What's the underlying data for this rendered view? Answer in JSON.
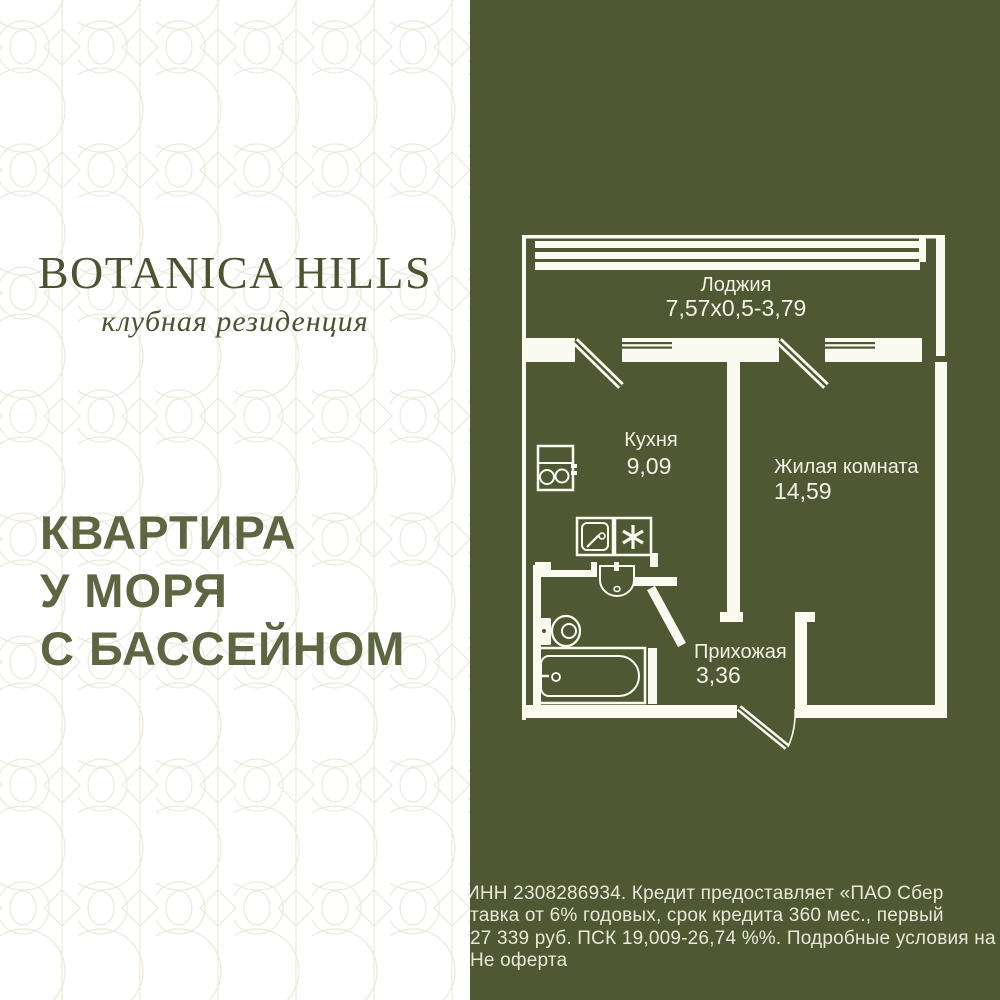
{
  "brand": {
    "name": "BOTANICA HILLS",
    "tagline": "клубная резиденция"
  },
  "headline": {
    "line1": "КВАРТИРА",
    "line2": "У МОРЯ",
    "line3": "С БАССЕЙНОМ"
  },
  "floor_plan": {
    "loggia_label": "Лоджия",
    "loggia_dims": "7,57x0,5-3,79",
    "kitchen_label": "Кухня",
    "kitchen_area": "9,09",
    "living_label": "Жилая комната",
    "living_area": "14,59",
    "hallway_label": "Прихожая",
    "hallway_area": "3,36"
  },
  "disclaimer": {
    "line1": "ИНН 2308286934. Кредит предоставляет «ПАО Сбер",
    "line2": "тавка от 6% годовых, срок кредита 360 мес., первый",
    "line3": "27 339 руб. ПСК 19,009-26,74 %%. Подробные условия на",
    "line4": "Не оферта"
  },
  "colors": {
    "olive_background": "#4f5733",
    "plan_line_white": "#fbfaf0",
    "headline_green": "#5d6541",
    "logo_green": "#4b5330",
    "pattern_line": "#ece8dc",
    "disclaimer_text": "#e9e8d9"
  }
}
